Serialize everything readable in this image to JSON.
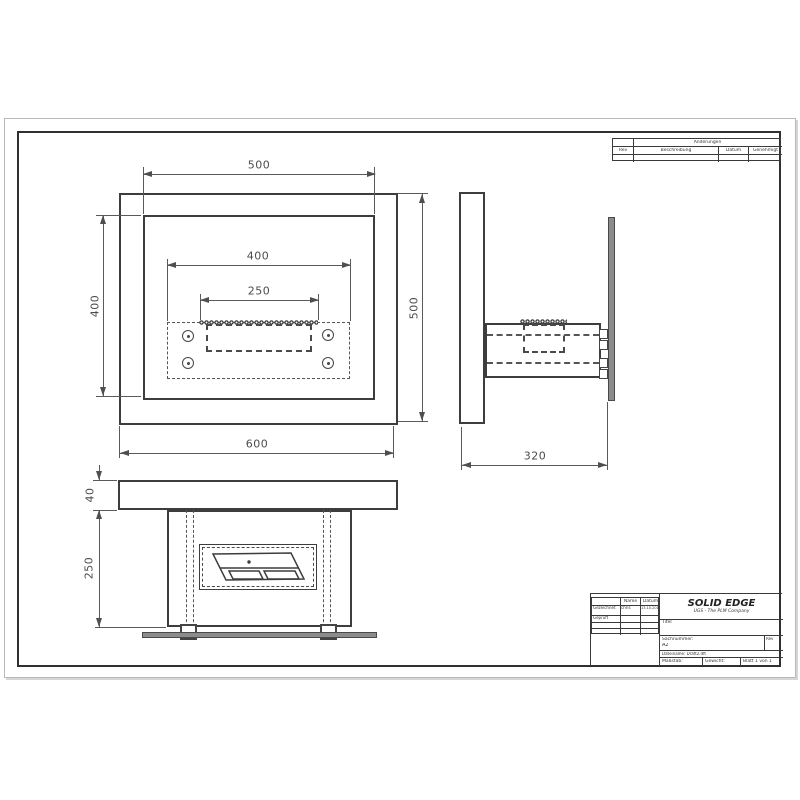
{
  "colors": {
    "line": "#3d3d3d",
    "dim": "#4f4f4f",
    "fill_gray": "#8c8c8c"
  },
  "dims": {
    "front_top_width": "500",
    "front_plate_width": "400",
    "front_slot_width": "250",
    "front_left_height": "400",
    "front_right_height": "500",
    "front_bottom_width": "600",
    "side_depth": "320",
    "bottom_top_thickness": "40",
    "bottom_body_height": "250"
  },
  "revision_table": {
    "header": "Änderungen",
    "col_rev": "Rev",
    "col_desc": "Beschreibung",
    "col_date": "Datum",
    "col_approved": "Genehmigt"
  },
  "title_block": {
    "brand": "SOLID EDGE",
    "brand_sub": "UGS - The PLM Company",
    "col_name": "Name",
    "col_date": "Datum",
    "row_drawn": "Gezeichnet",
    "row_checked": "Geprüft",
    "drawn_name": "chris",
    "drawn_date": "13.10.2011",
    "title_label": "Titel",
    "partno_label": "Sachnummer:",
    "partno_value": "A2",
    "rev_label": "Rev",
    "filename_label": "Dateiname: Draft2.dft",
    "scale_label": "Maßstab:",
    "weight_label": "Gewicht:",
    "sheet_label": "Blatt 1 von 1"
  }
}
